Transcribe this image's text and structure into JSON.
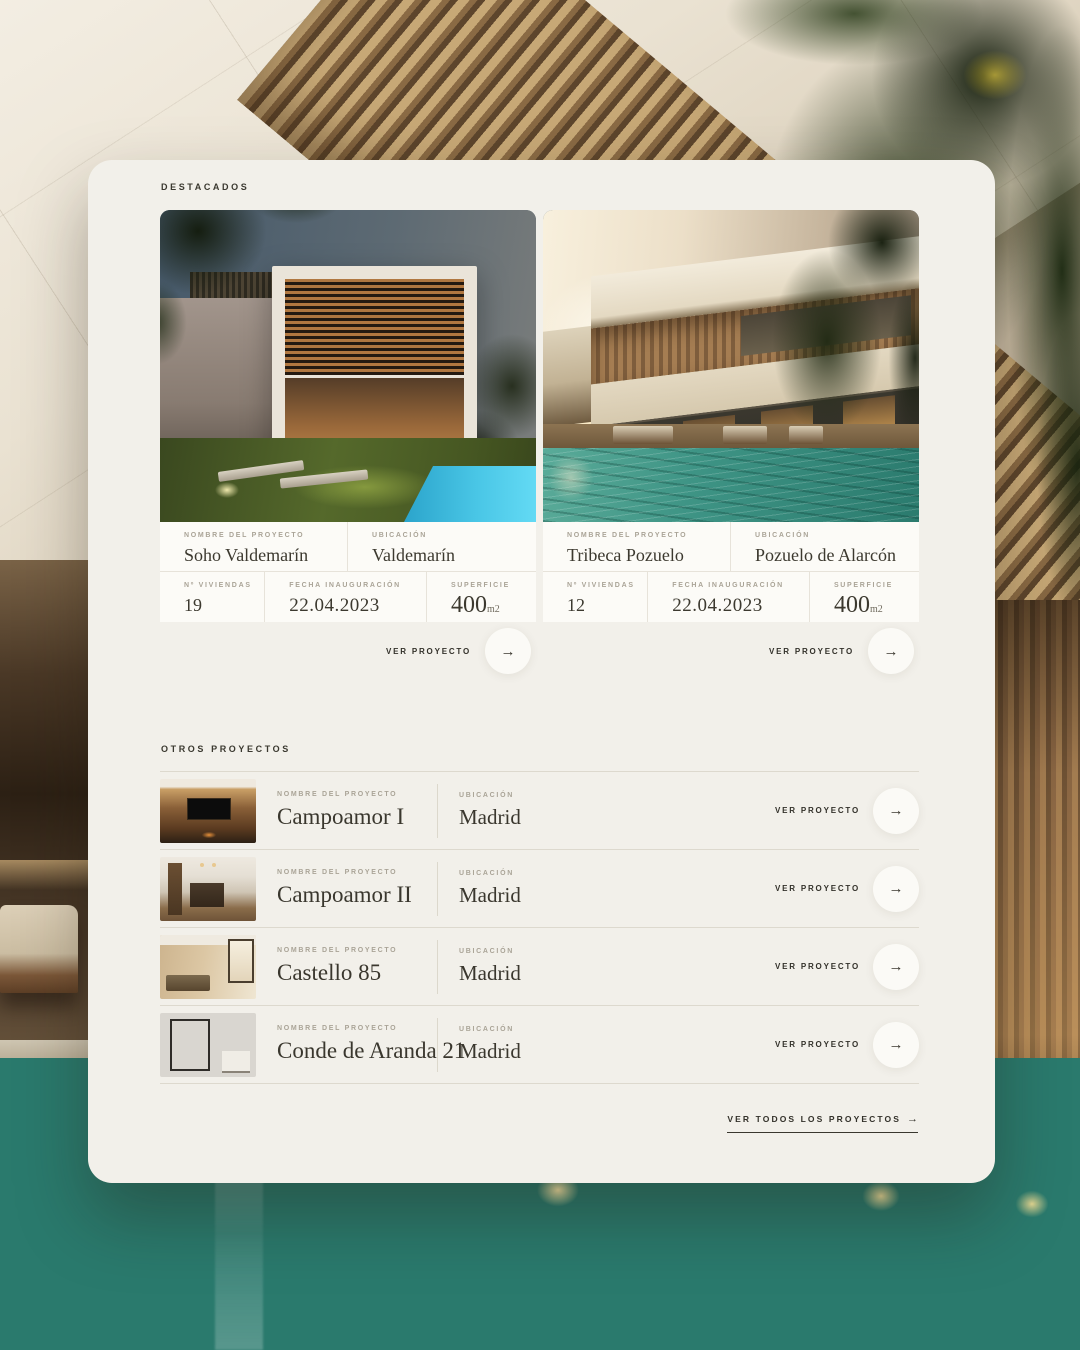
{
  "colors": {
    "panel_bg": "#f2f0ea",
    "surface": "#fcfbf7",
    "text_dark": "#33312a",
    "label_muted": "#aaa497",
    "divider": "#ddd9ce",
    "pool_teal": "#2a7a6d"
  },
  "featured": {
    "heading": "DESTACADOS",
    "labels": {
      "name": "NOMBRE DEL PROYECTO",
      "location": "UBICACIÓN",
      "units": "Nº VIVIENDAS",
      "date": "FECHA INAUGURACIÓN",
      "area": "SUPERFICIE"
    },
    "cta_label": "VER PROYECTO",
    "arrow": "→",
    "cards": [
      {
        "name": "Soho Valdemarín",
        "location": "Valdemarín",
        "units": "19",
        "date": "22.04.2023",
        "area_value": "400",
        "area_unit": "m2",
        "image": "dusk-cubic-villa-with-garden-and-pool"
      },
      {
        "name": "Tribeca Pozuelo",
        "location": "Pozuelo de Alarcón",
        "units": "12",
        "date": "22.04.2023",
        "area_value": "400",
        "area_unit": "m2",
        "image": "sunset-villa-with-large-pool"
      }
    ]
  },
  "others": {
    "heading": "OTROS PROYECTOS",
    "labels": {
      "name": "NOMBRE DEL PROYECTO",
      "location": "UBICACIÓN"
    },
    "cta_label": "VER PROYECTO",
    "arrow": "→",
    "items": [
      {
        "name": "Campoamor I",
        "location": "Madrid",
        "thumb": "tv-lounge-wood-wall"
      },
      {
        "name": "Campoamor II",
        "location": "Madrid",
        "thumb": "kitchen-dark-island"
      },
      {
        "name": "Castello 85",
        "location": "Madrid",
        "thumb": "warm-living-room"
      },
      {
        "name": "Conde de Aranda 21",
        "location": "Madrid",
        "thumb": "marble-bathroom"
      }
    ],
    "view_all_label": "VER TODOS LOS PROYECTOS",
    "view_all_arrow": "→"
  }
}
